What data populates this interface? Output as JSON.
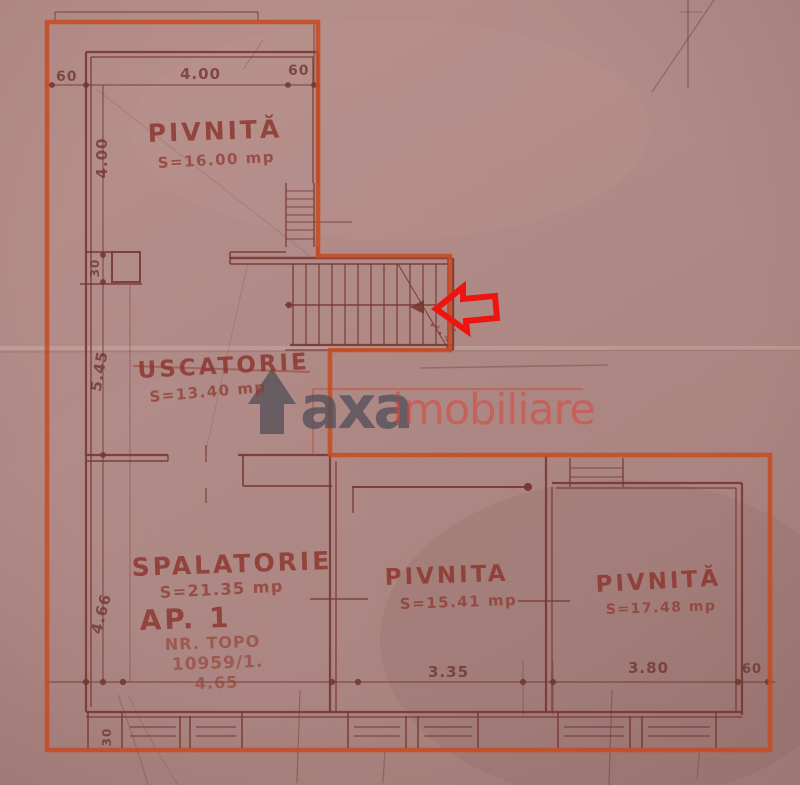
{
  "rooms": {
    "pivnita_top": {
      "name": "PIVNITĂ",
      "area": "S=16.00 mp"
    },
    "uscatorie": {
      "name": "USCATORIE",
      "area": "S=13.40 mp"
    },
    "spalatorie": {
      "name": "SPALATORIE",
      "area": "S=21.35 mp"
    },
    "pivnita_mid": {
      "name": "PIVNITA",
      "area": "S=15.41 mp"
    },
    "pivnita_right": {
      "name": "PIVNITĂ",
      "area": "S=17.48 mp"
    }
  },
  "apartment": {
    "label": "AP. 1",
    "nr_topo": "NR. TOPO",
    "topo_number": "10959/1.",
    "front_dim": "4.65"
  },
  "dimensions": {
    "top": {
      "left_wall": "60",
      "span": "4.00",
      "right_wall": "60"
    },
    "left": {
      "upper": "4.00",
      "pier": "30",
      "middle": "5.45",
      "lower": "4.66",
      "bottom_wall": "30"
    },
    "bottom": {
      "mid_span": "3.35",
      "right_span": "3.80",
      "right_wall": "60"
    }
  },
  "watermark": {
    "brand_bold": "axa",
    "brand_light": "imobiliare"
  },
  "colors": {
    "paper": "#b18c88",
    "ink": "#7b3a34",
    "boundary": "#c84a22",
    "annotation_arrow": "#ee1510",
    "watermark_gray": "#54505a",
    "watermark_red": "#d8443e"
  }
}
